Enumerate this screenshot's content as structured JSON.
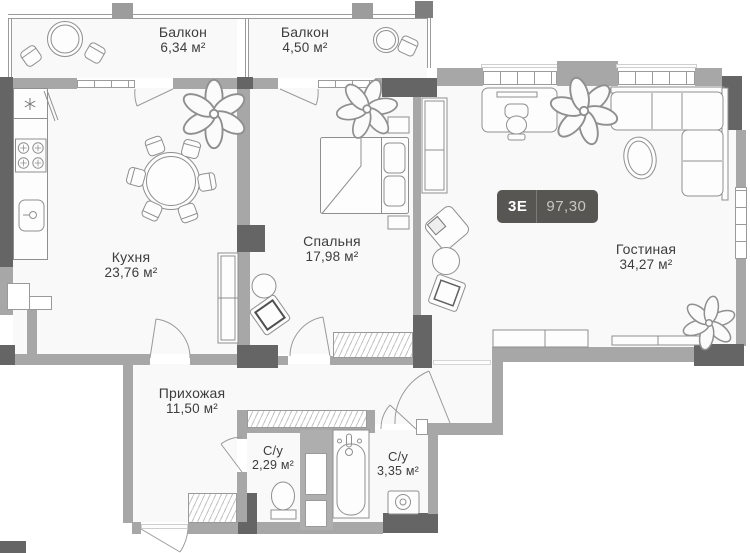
{
  "plan": {
    "badge": {
      "type": "3Е",
      "area": "97,30"
    },
    "rooms": {
      "balcony_left": {
        "name": "Балкон",
        "area": "6,34 м²"
      },
      "balcony_right": {
        "name": "Балкон",
        "area": "4,50 м²"
      },
      "kitchen": {
        "name": "Кухня",
        "area": "23,76 м²"
      },
      "bedroom": {
        "name": "Спальня",
        "area": "17,98 м²"
      },
      "living_room": {
        "name": "Гостиная",
        "area": "34,27 м²"
      },
      "hallway": {
        "name": "Прихожая",
        "area": "11,50 м²"
      },
      "bathroom_small": {
        "name": "С/у",
        "area": "2,29 м²"
      },
      "bathroom_large": {
        "name": "С/у",
        "area": "3,35 м²"
      }
    },
    "colors": {
      "wall": "#a7a7a7",
      "wall_dark": "#656565",
      "badge_bg": "#585653",
      "badge_text": "#ffffff",
      "badge_area_text": "#c9c7c3",
      "label_text": "#3d3d3d"
    }
  }
}
